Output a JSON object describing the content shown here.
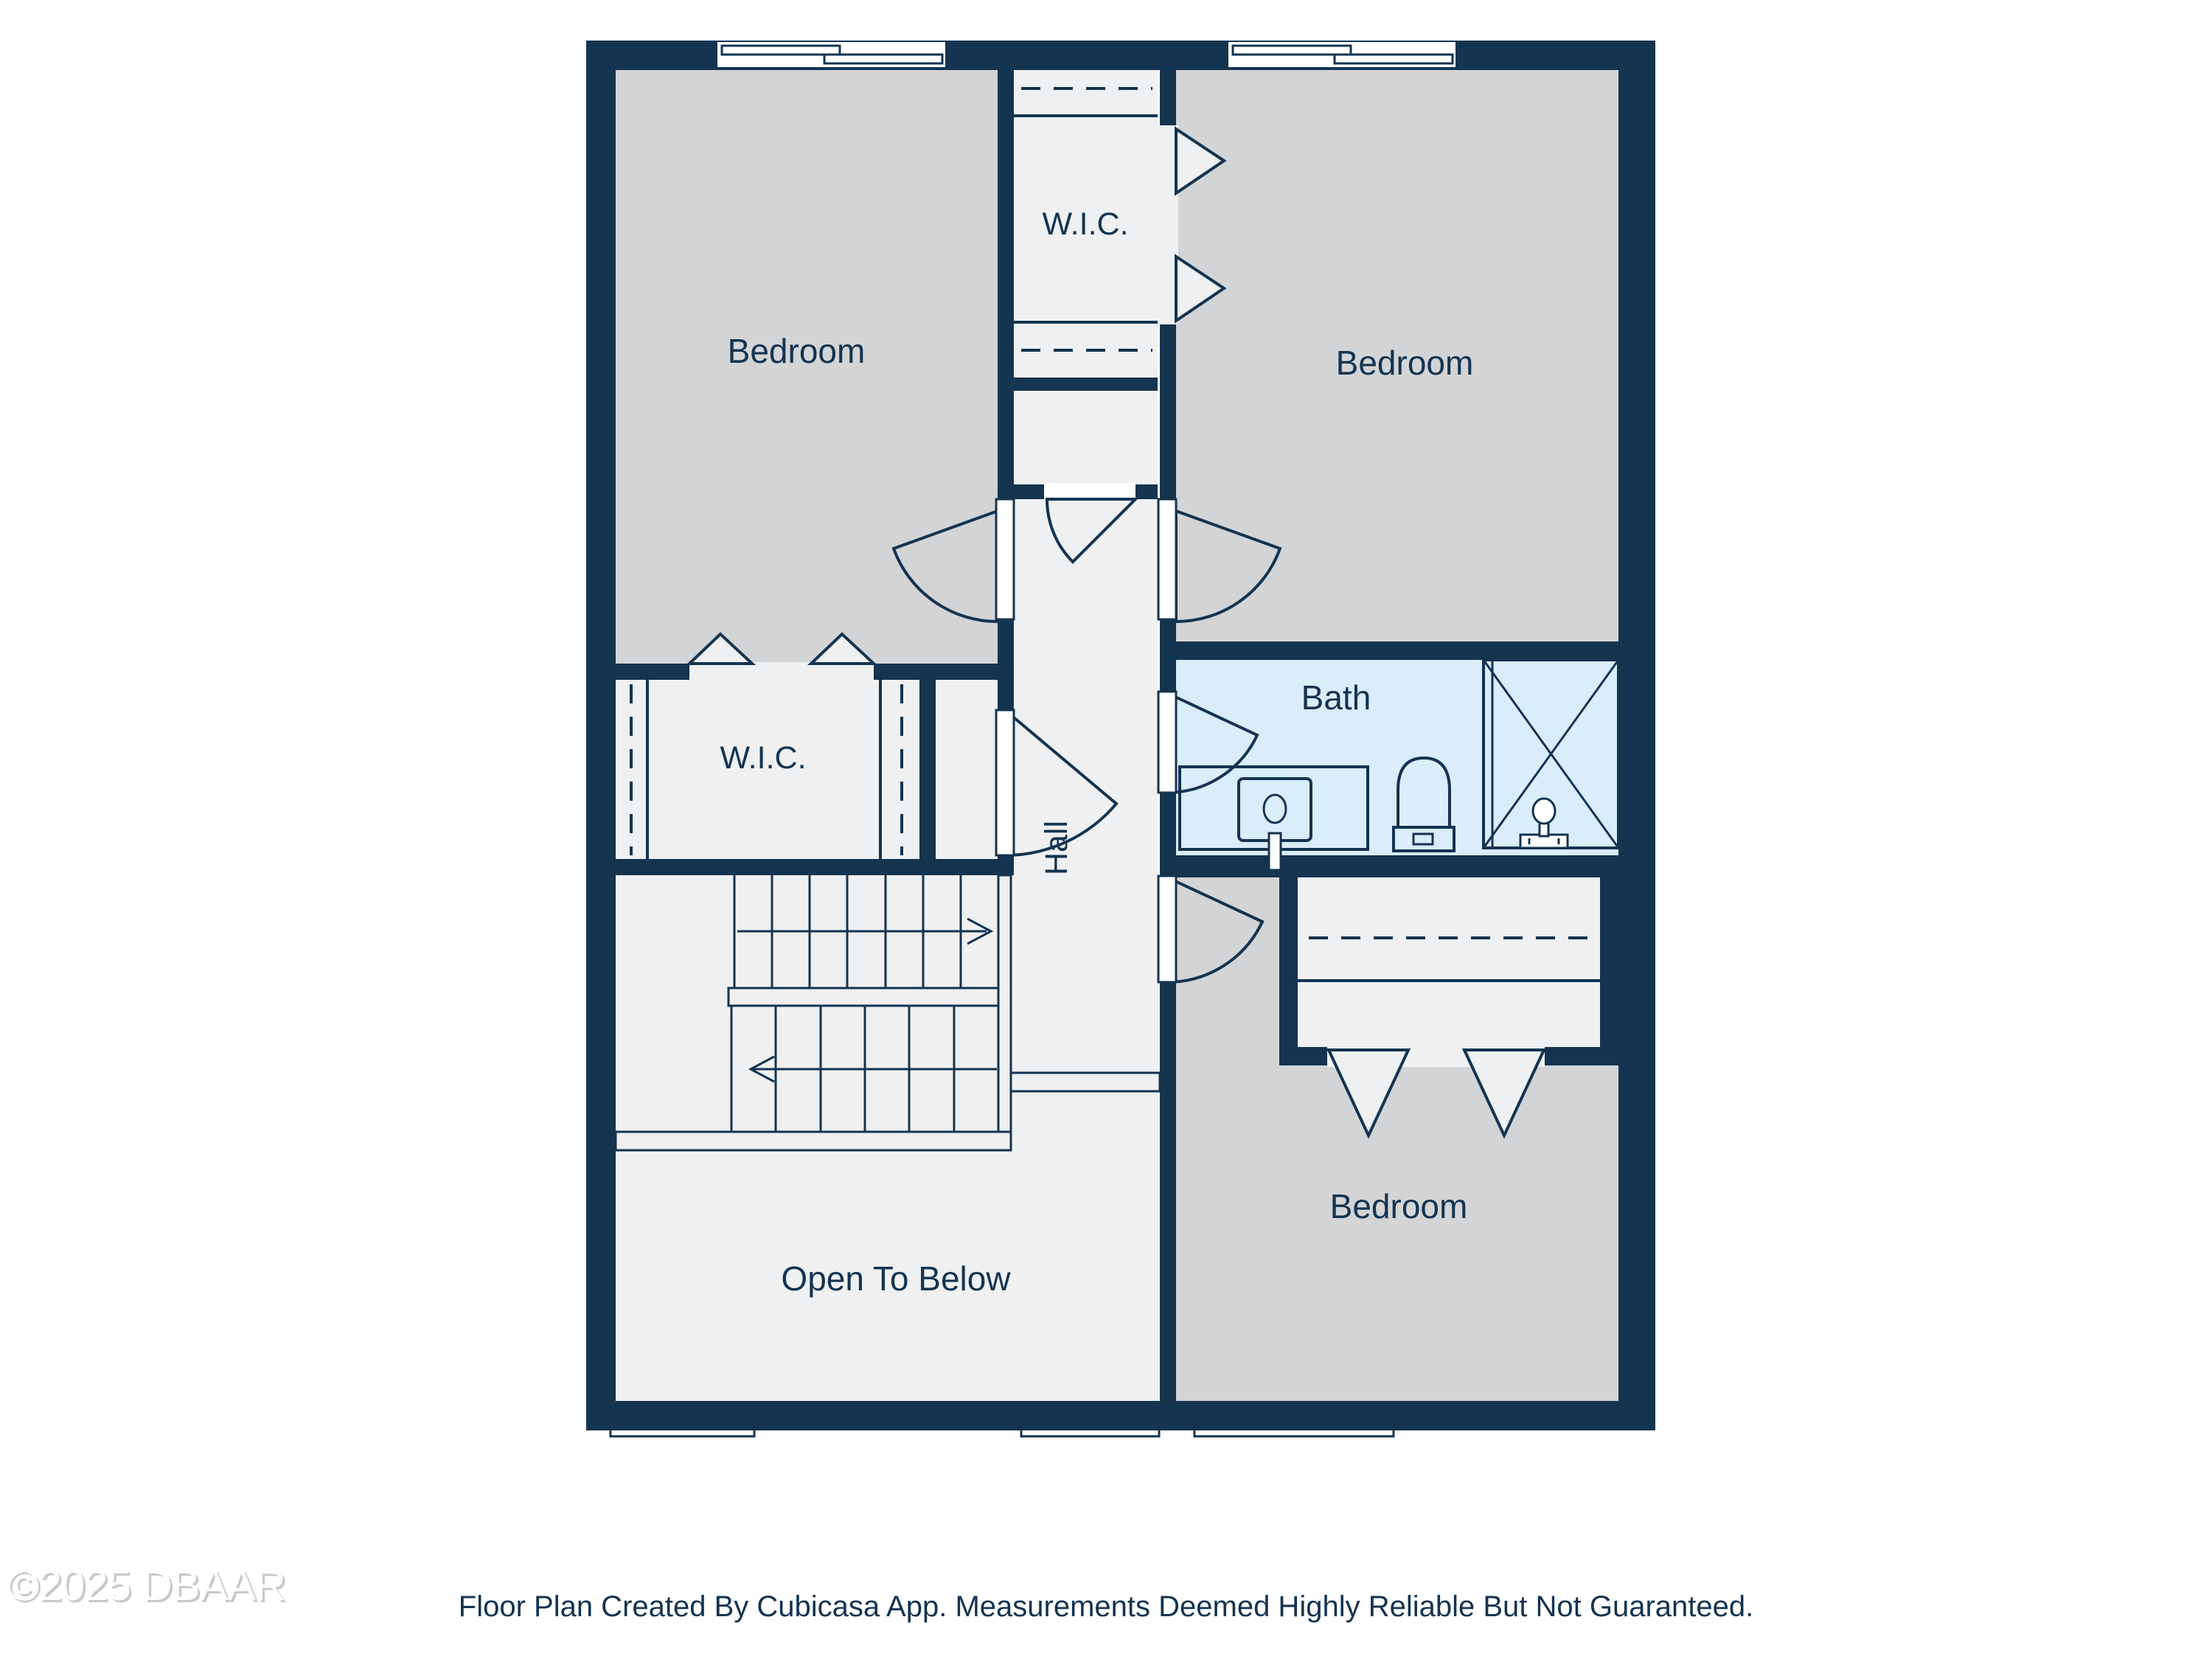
{
  "colors": {
    "wall": "#143450",
    "bedroom_floor": "#d3d4d6",
    "light_floor": "#eef0f1",
    "bath_floor": "#d9edfb",
    "text": "#143450",
    "background": "#ffffff",
    "watermark_shadow": "#c8c8c8"
  },
  "rooms": {
    "bedroom_top_left": {
      "label": "Bedroom"
    },
    "bedroom_top_right": {
      "label": "Bedroom"
    },
    "bedroom_bottom_right": {
      "label": "Bedroom"
    },
    "wic_top": {
      "label": "W.I.C."
    },
    "wic_left": {
      "label": "W.I.C."
    },
    "bath": {
      "label": "Bath"
    },
    "hall": {
      "label": "Hall"
    },
    "open_to_below": {
      "label": "Open To Below"
    }
  },
  "icons": {
    "stair_up_arrow": "arrow-right",
    "stair_down_arrow": "arrow-left",
    "door_swing": "quarter-arc",
    "bifold_door": "triangle",
    "window": "double-pane-bar"
  },
  "footer": {
    "disclaimer": "Floor Plan Created By Cubicasa App. Measurements Deemed Highly Reliable But Not Guaranteed."
  },
  "watermark": "©2025 DBAAR"
}
